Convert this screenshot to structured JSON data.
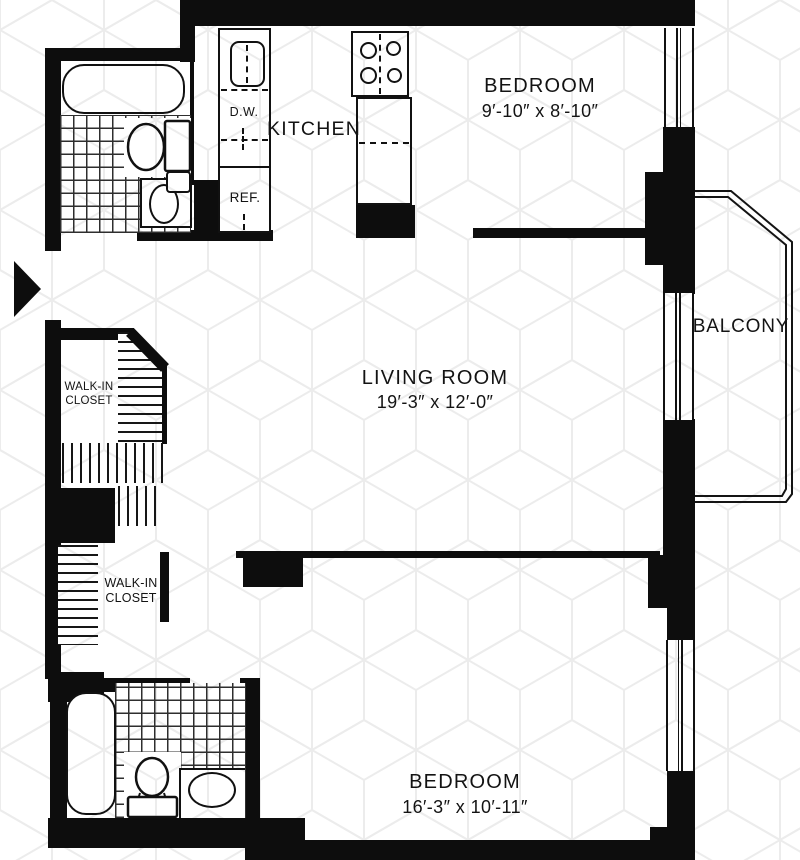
{
  "plan": {
    "type": "apartment-floor-plan",
    "rooms": {
      "kitchen": {
        "label": "KITCHEN"
      },
      "bedroom_top": {
        "label": "BEDROOM",
        "dimensions": "9′-10″ x 8′-10″"
      },
      "living_room": {
        "label": "LIVING ROOM",
        "dimensions": "19′-3″ x 12′-0″"
      },
      "balcony": {
        "label": "BALCONY"
      },
      "bedroom_bottom": {
        "label": "BEDROOM",
        "dimensions": "16′-3″ x 10′-11″"
      },
      "closet_top": {
        "line1": "WALK-IN",
        "line2": "CLOSET"
      },
      "closet_bottom": {
        "line1": "WALK-IN",
        "line2": "CLOSET"
      }
    },
    "appliances": {
      "dishwasher": {
        "label": "D.W."
      },
      "refrigerator": {
        "label": "REF."
      }
    },
    "fixtures": [
      "bathtub",
      "toilet",
      "sink",
      "stove-4-burner",
      "kitchen-cabinet",
      "counter"
    ],
    "colors": {
      "wall": "#0d0d0d",
      "text": "#131313",
      "tile_line": "#2e2e2e",
      "watermark": "#ececec",
      "background": "#ffffff"
    }
  }
}
